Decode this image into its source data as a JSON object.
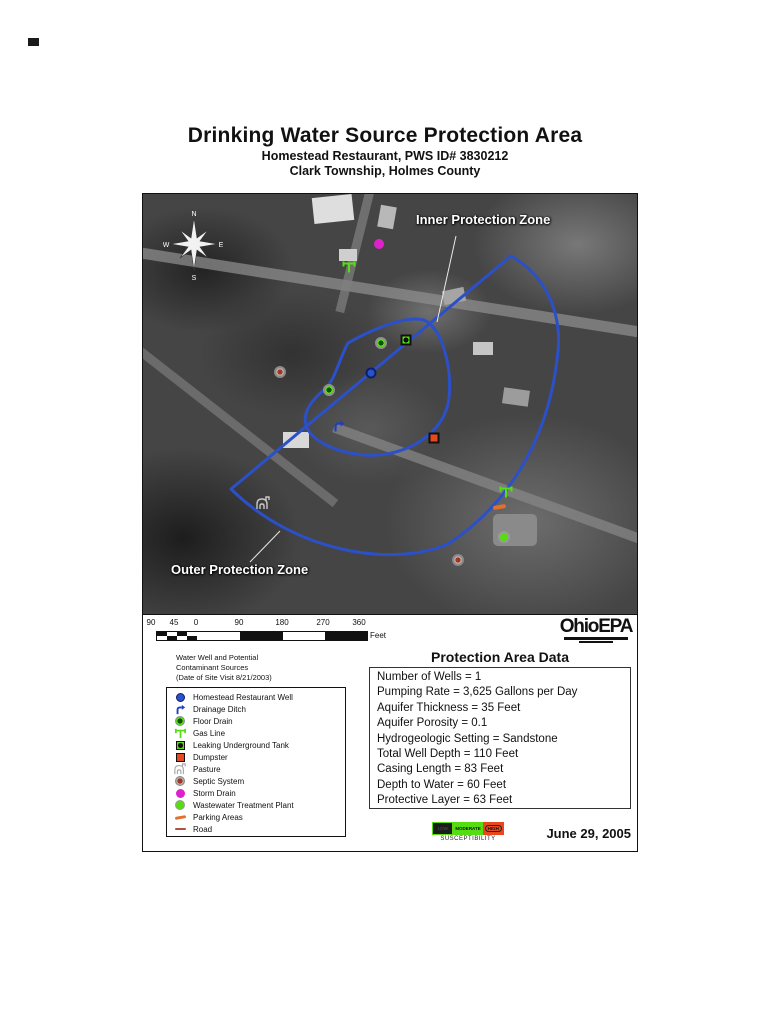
{
  "title": {
    "main": "Drinking Water Source Protection Area",
    "subtitle1": "Homestead Restaurant, PWS ID# 3830212",
    "subtitle2": "Clark Township, Holmes County"
  },
  "map": {
    "inner_zone_label": "Inner Protection Zone",
    "outer_zone_label": "Outer Protection Zone",
    "compass": {
      "north": "N",
      "south": "S",
      "east": "E",
      "west": "W"
    },
    "zone_color": "#2b50c8"
  },
  "scale_bar": {
    "ticks": [
      "90",
      "45",
      "0",
      "90",
      "180",
      "270",
      "360"
    ],
    "unit": "Feet"
  },
  "logo": {
    "ohio": "Ohio",
    "epa": "EPA"
  },
  "legend": {
    "header_line1": "Water Well and Potential",
    "header_line2": "Contaminant Sources",
    "header_line3": "(Date of Site Visit 8/21/2003)",
    "items": [
      {
        "icon": "well-icon",
        "label": "Homestead Restaurant Well"
      },
      {
        "icon": "drainage-ditch-icon",
        "label": "Drainage Ditch"
      },
      {
        "icon": "floor-drain-icon",
        "label": "Floor Drain"
      },
      {
        "icon": "gas-line-icon",
        "label": "Gas Line"
      },
      {
        "icon": "leaking-underground-tank-icon",
        "label": "Leaking Underground Tank"
      },
      {
        "icon": "dumpster-icon",
        "label": "Dumpster"
      },
      {
        "icon": "pasture-icon",
        "label": "Pasture"
      },
      {
        "icon": "septic-system-icon",
        "label": "Septic System"
      },
      {
        "icon": "storm-drain-icon",
        "label": "Storm Drain"
      },
      {
        "icon": "wastewater-treatment-plant-icon",
        "label": "Wastewater Treatment Plant"
      },
      {
        "icon": "parking-areas-icon",
        "label": "Parking Areas"
      },
      {
        "icon": "road-icon",
        "label": "Road"
      }
    ]
  },
  "data_box": {
    "title": "Protection Area Data",
    "lines": [
      "Number of Wells = 1",
      "Pumping Rate = 3,625 Gallons per Day",
      "Aquifer Thickness = 35 Feet",
      "Aquifer Porosity = 0.1",
      "Hydrogeologic Setting = Sandstone",
      "Total Well Depth = 110 Feet",
      "Casing Length = 83 Feet",
      "Depth to Water = 60 Feet",
      "Protective Layer = 63 Feet"
    ]
  },
  "susceptibility": {
    "label": "SUSCEPTIBILITY",
    "low": "LOW",
    "moderate": "MODERATE",
    "high": "HIGH"
  },
  "date": "June 29, 2005"
}
